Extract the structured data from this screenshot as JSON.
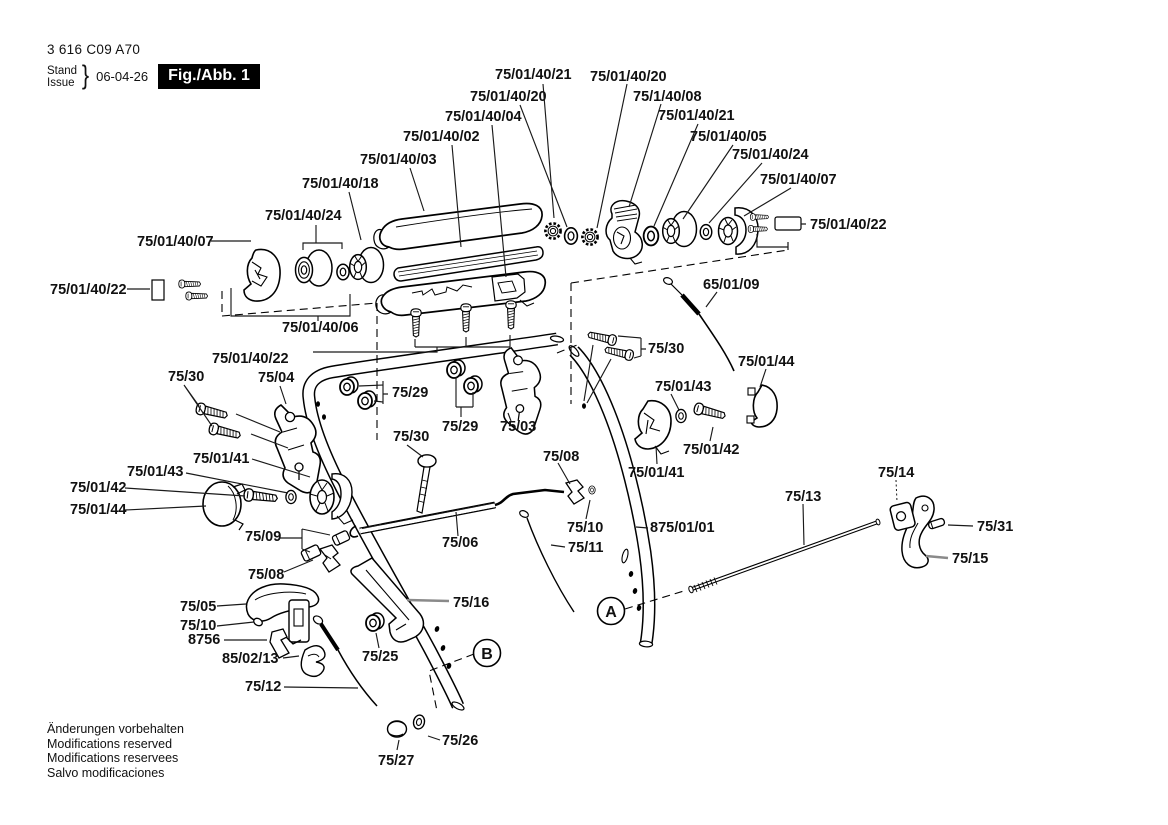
{
  "document": {
    "number": "3 616 C09 A70",
    "stand_label": "Stand",
    "issue_label": "Issue",
    "brace": "}",
    "date": "06-04-26",
    "figure_label": "Fig./Abb. 1"
  },
  "footer": {
    "line1": "Änderungen vorbehalten",
    "line2": "Modifications reserved",
    "line3": "Modifications reservees",
    "line4": "Salvo modificaciones"
  },
  "markers": {
    "a": "A",
    "b": "B"
  },
  "part_numbers": {
    "handle_upper_shell": "75/01/40/03",
    "handle_bar": "75/01/40/02",
    "handle_lower_shell": "75/01/40/04",
    "shell_screws": "75/01/40/22",
    "star_nut": "75/01/40/21",
    "washer_small": "75/01/40/20",
    "cam_lever": "75/1/40/08",
    "roller": "75/01/40/05",
    "spacer_washer": "75/01/40/24",
    "end_cap": "75/01/40/07",
    "bushing_set": "75/01/40/06",
    "grip_roller": "75/01/40/18",
    "bowden_cable": "65/01/09",
    "screw_pair": "75/30",
    "hinge_left": "75/04",
    "hinge_right": "75/03",
    "flange_nut": "75/29",
    "clamp": "75/08",
    "pulley": "75/01/41",
    "pulley_screw": "75/01/42",
    "pulley_washer": "75/01/43",
    "cover_cap": "75/01/44",
    "link_rod": "75/06",
    "sleeve_set": "75/09",
    "washer": "75/10",
    "cable_thin": "75/11",
    "handle_tube_right": "875/01/01",
    "brake_lever": "75/05",
    "bearing_piece": "8756",
    "spring_clip": "85/02/13",
    "cable_lower": "75/12",
    "bracket_strap": "75/16",
    "lock_nut": "75/25",
    "washer_lower": "75/26",
    "cap_nut": "75/27",
    "control_rod": "75/13",
    "rod_block": "75/14",
    "trigger": "75/15",
    "pin": "75/31"
  }
}
